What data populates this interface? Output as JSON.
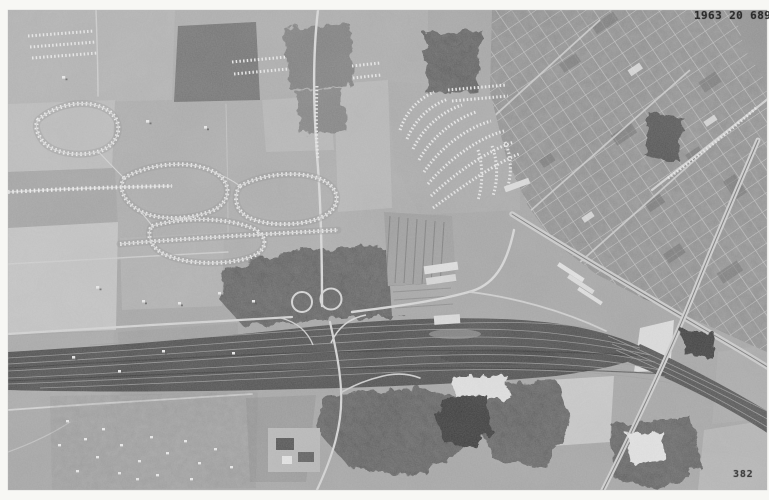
{
  "photo": {
    "stamp_top_right": "1963 20 689",
    "stamp_bottom_right": "382"
  },
  "palette": {
    "border_white": "#f7f7f4",
    "base_gray": "#a4a4a4",
    "woods_gray": "#535353",
    "railyard_gray": "#454545",
    "road_light": "#d8d8d8",
    "water_dark": "#2e2e2e",
    "stamp_ink": "#1d1d1d"
  }
}
